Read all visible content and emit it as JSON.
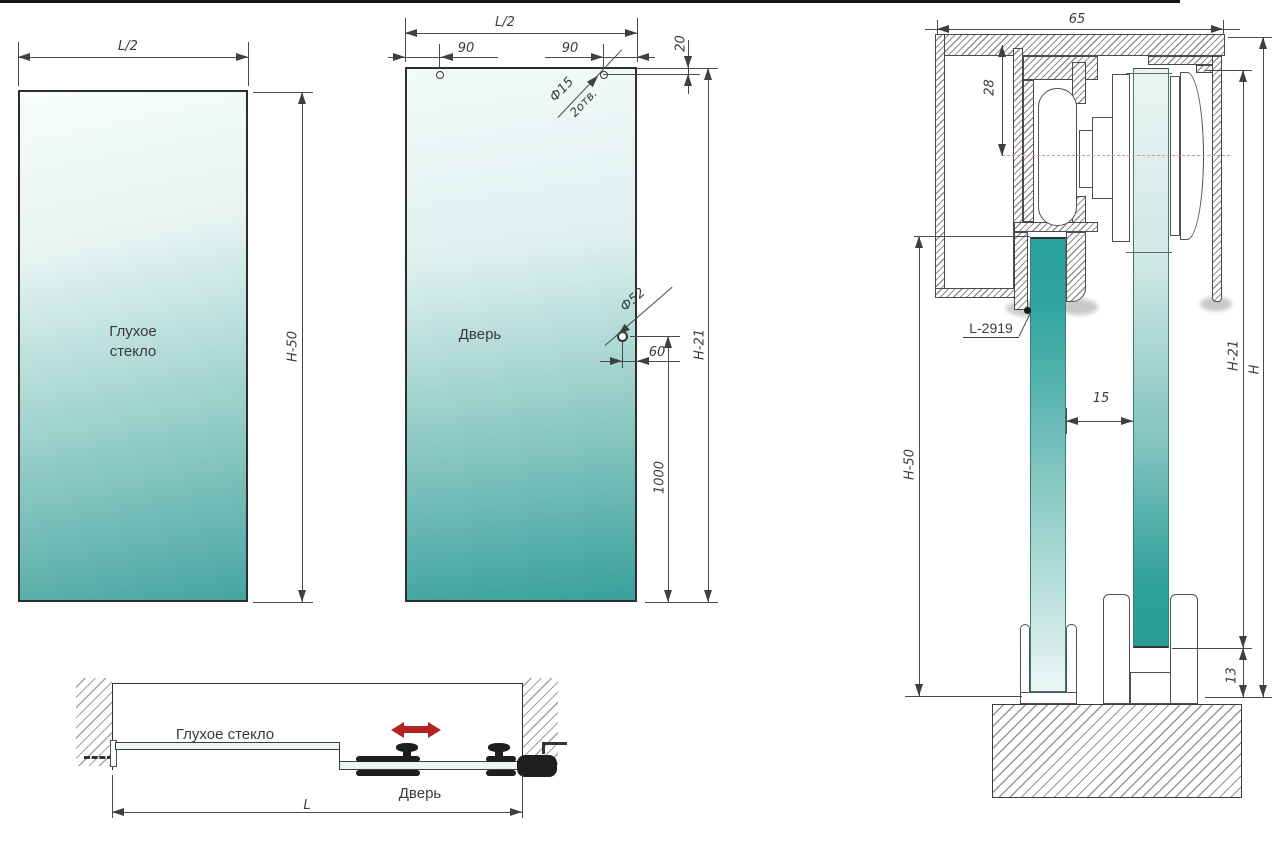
{
  "colors": {
    "teal": "#3fa39e",
    "line": "#3f3f3f",
    "red_arrow": "#b2221f",
    "red_centerline": "#e89090"
  },
  "left_panel": {
    "label_line1": "Глухое",
    "label_line2": "стекло",
    "width_dim": "L/2",
    "height_dim": "H-50"
  },
  "door_panel": {
    "label": "Дверь",
    "width_dim": "L/2",
    "hole_offset_left": "90",
    "hole_offset_right": "90",
    "hole_top_offset": "20",
    "top_hole_dia": "Ф15",
    "top_hole_qty": "2отв.",
    "mid_hole_dia": "Ф52",
    "mid_hole_edge_offset": "60",
    "mid_hole_bottom_offset": "1000",
    "height_dim": "H-21"
  },
  "section": {
    "top_width": "65",
    "axis_offset": "28",
    "profile_code": "L-2919",
    "glass_gap": "15",
    "fixed_glass_height": "H-50",
    "door_height": "H-21",
    "total_height": "H",
    "floor_clearance": "13"
  },
  "plan": {
    "fixed_label": "Глухое стекло",
    "door_label": "Дверь",
    "length_dim": "L"
  }
}
